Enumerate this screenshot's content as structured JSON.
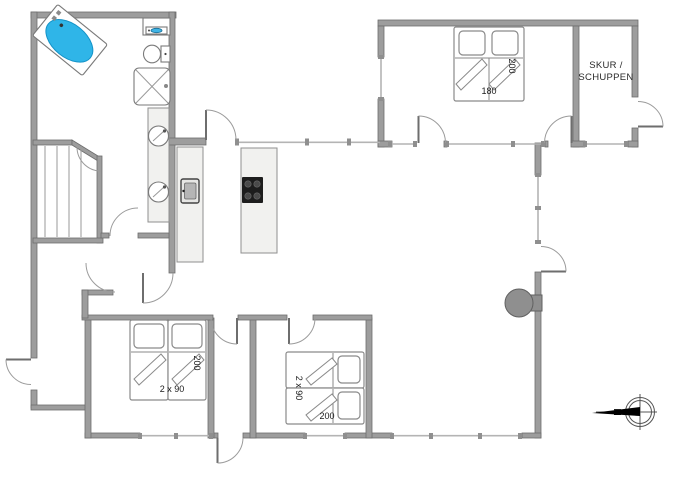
{
  "plan": {
    "rooms": {
      "shed": {
        "label_line_1": "SKUR /",
        "label_line_2": "SCHUPPEN"
      },
      "bedroom_top_right": {
        "bed_width": "180",
        "bed_length": "200"
      },
      "bedroom_bottom_left": {
        "beds": "2 x 90",
        "bed_length": "200"
      },
      "bedroom_bottom_middle": {
        "beds": "2 x 90",
        "bed_length": "200"
      }
    },
    "compass": {
      "north_label": "N"
    },
    "fixtures": {
      "bathtub": "bathtub-icon",
      "washing_machine": "washing-machine-icon",
      "toilet": "toilet-icon",
      "shower": "shower-icon",
      "double_washbasin": "double-washbasin-icon",
      "oven": "oven-icon",
      "cooktop": "cooktop-icon",
      "kitchen_island": "kitchen-island",
      "wood_stove": "wood-stove-icon",
      "staircase": "staircase-icon",
      "compass": "compass-icon"
    },
    "colors": {
      "wall": "#9d9d9d",
      "wall_outline": "#6e6e6e",
      "counter_fill": "#f1f1ef",
      "bathtub_water": "#2fb5e8",
      "cooktop": "#1d1d1d",
      "stove": "#8f8f8f",
      "label_text": "#1a1a1a"
    }
  }
}
